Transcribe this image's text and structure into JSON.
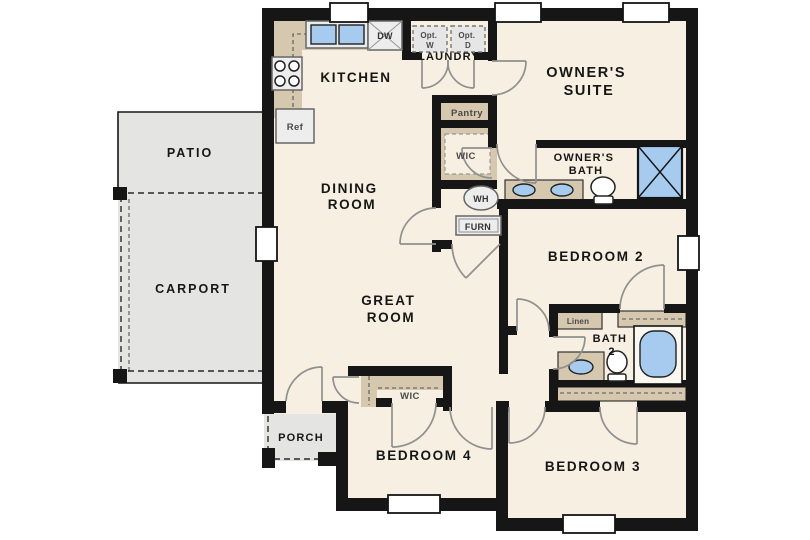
{
  "floorplan": {
    "rooms": {
      "patio": "PATIO",
      "carport": "CARPORT",
      "porch": "PORCH",
      "kitchen": "KITCHEN",
      "laundry": "LAUNDRY",
      "dining": [
        "DINING",
        "ROOM"
      ],
      "great": [
        "GREAT",
        "ROOM"
      ],
      "owners_suite": [
        "OWNER'S",
        "SUITE"
      ],
      "owners_bath": [
        "OWNER'S",
        "BATH"
      ],
      "bath2": [
        "BATH",
        "2"
      ],
      "bedroom2": "BEDROOM 2",
      "bedroom3": "BEDROOM 3",
      "bedroom4": "BEDROOM 4"
    },
    "closets": {
      "pantry": "Pantry",
      "owners_wic": "WIC",
      "bedroom4_wic": "WIC",
      "linen": "Linen"
    },
    "appliances": {
      "refrigerator": "Ref",
      "dishwasher": "DW",
      "opt_washer": [
        "Opt.",
        "W"
      ],
      "opt_dryer": [
        "Opt.",
        "D"
      ],
      "water_heater": "WH",
      "furnace": "FURN"
    },
    "colors": {
      "wall": "#161616",
      "floor": "#f7efe1",
      "casework": "#d5c8ae",
      "exterior_concrete": "#e4e4e2",
      "fixture_blue": "#a6cbee",
      "appliance_gray": "#ededed"
    }
  }
}
